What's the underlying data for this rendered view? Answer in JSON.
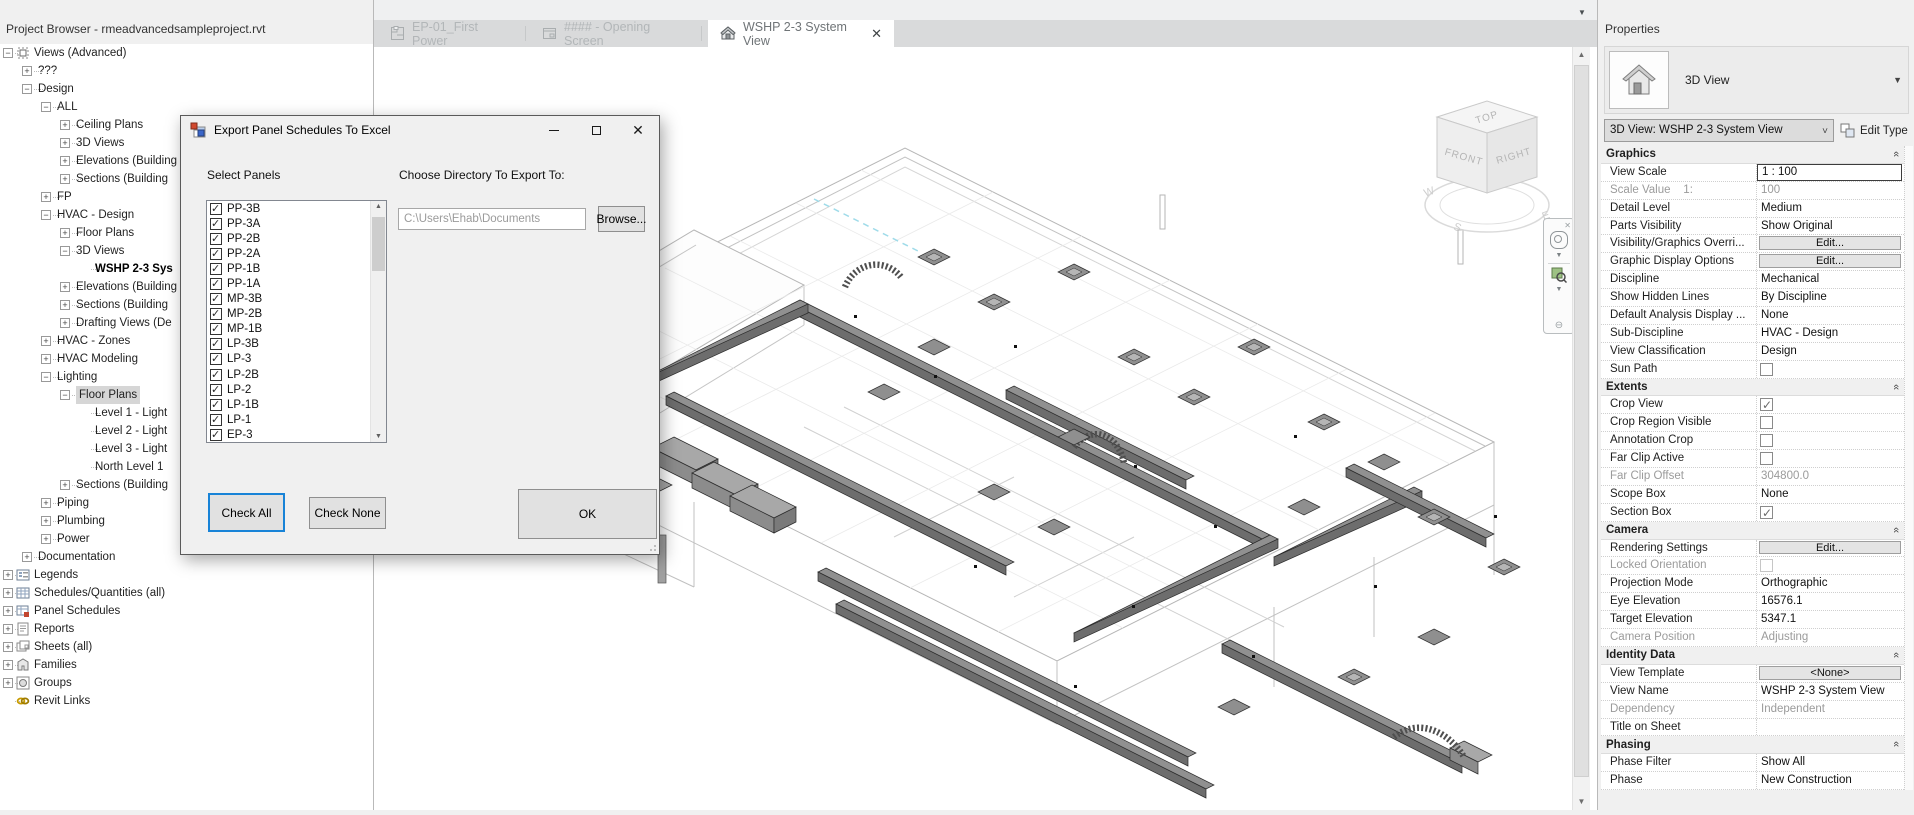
{
  "project_browser": {
    "title": "Project Browser - rmeadvancedsampleproject.rvt",
    "tree": [
      {
        "label": "Views (Advanced)",
        "level": 0,
        "toggle": "minus",
        "icon": "views"
      },
      {
        "label": "???",
        "level": 1,
        "toggle": "plus"
      },
      {
        "label": "Design",
        "level": 1,
        "toggle": "minus"
      },
      {
        "label": "ALL",
        "level": 2,
        "toggle": "minus"
      },
      {
        "label": "Ceiling Plans",
        "level": 3,
        "toggle": "plus"
      },
      {
        "label": "3D Views",
        "level": 3,
        "toggle": "plus"
      },
      {
        "label": "Elevations (Building",
        "level": 3,
        "toggle": "plus"
      },
      {
        "label": "Sections (Building",
        "level": 3,
        "toggle": "plus"
      },
      {
        "label": "FP",
        "level": 2,
        "toggle": "plus"
      },
      {
        "label": "HVAC - Design",
        "level": 2,
        "toggle": "minus"
      },
      {
        "label": "Floor Plans",
        "level": 3,
        "toggle": "plus"
      },
      {
        "label": "3D Views",
        "level": 3,
        "toggle": "minus"
      },
      {
        "label": "WSHP 2-3 Sys",
        "level": 4,
        "toggle": "none",
        "bold": true
      },
      {
        "label": "Elevations (Building",
        "level": 3,
        "toggle": "plus"
      },
      {
        "label": "Sections (Building",
        "level": 3,
        "toggle": "plus"
      },
      {
        "label": "Drafting Views (De",
        "level": 3,
        "toggle": "plus"
      },
      {
        "label": "HVAC - Zones",
        "level": 2,
        "toggle": "plus"
      },
      {
        "label": "HVAC Modeling",
        "level": 2,
        "toggle": "plus"
      },
      {
        "label": "Lighting",
        "level": 2,
        "toggle": "minus"
      },
      {
        "label": "Floor Plans",
        "level": 3,
        "toggle": "minus",
        "selected": true
      },
      {
        "label": "Level 1 - Light",
        "level": 4,
        "toggle": "none"
      },
      {
        "label": "Level 2 - Light",
        "level": 4,
        "toggle": "none"
      },
      {
        "label": "Level 3 - Light",
        "level": 4,
        "toggle": "none"
      },
      {
        "label": "North Level 1",
        "level": 4,
        "toggle": "none"
      },
      {
        "label": "Sections (Building",
        "level": 3,
        "toggle": "plus"
      },
      {
        "label": "Piping",
        "level": 2,
        "toggle": "plus"
      },
      {
        "label": "Plumbing",
        "level": 2,
        "toggle": "plus"
      },
      {
        "label": "Power",
        "level": 2,
        "toggle": "plus"
      },
      {
        "label": "Documentation",
        "level": 1,
        "toggle": "plus"
      },
      {
        "label": "Legends",
        "level": 0,
        "toggle": "plus",
        "icon": "legends"
      },
      {
        "label": "Schedules/Quantities (all)",
        "level": 0,
        "toggle": "plus",
        "icon": "schedule"
      },
      {
        "label": "Panel Schedules",
        "level": 0,
        "toggle": "plus",
        "icon": "panel-schedule"
      },
      {
        "label": "Reports",
        "level": 0,
        "toggle": "plus",
        "icon": "report"
      },
      {
        "label": "Sheets (all)",
        "level": 0,
        "toggle": "plus",
        "icon": "sheets"
      },
      {
        "label": "Families",
        "level": 0,
        "toggle": "plus",
        "icon": "families"
      },
      {
        "label": "Groups",
        "level": 0,
        "toggle": "plus",
        "icon": "groups"
      },
      {
        "label": "Revit Links",
        "level": 0,
        "toggle": "none",
        "icon": "link"
      }
    ]
  },
  "tabs": [
    {
      "label": "EP-01_First Power",
      "icon": "floor-plan-icon",
      "active": false
    },
    {
      "label": "#### - Opening Screen",
      "icon": "sheet-icon",
      "active": false
    },
    {
      "label": "WSHP 2-3 System View",
      "icon": "3d-view-icon",
      "active": true,
      "closable": true
    }
  ],
  "dialog": {
    "title": "Export Panel Schedules To Excel",
    "select_panels_label": "Select Panels",
    "directory_label": "Choose Directory To Export To:",
    "directory_path": "C:\\Users\\Ehab\\Documents",
    "browse_label": "Browse...",
    "check_all_label": "Check All",
    "check_none_label": "Check None",
    "ok_label": "OK",
    "panels": [
      {
        "name": "PP-3B",
        "checked": true
      },
      {
        "name": "PP-3A",
        "checked": true
      },
      {
        "name": "PP-2B",
        "checked": true
      },
      {
        "name": "PP-2A",
        "checked": true
      },
      {
        "name": "PP-1B",
        "checked": true
      },
      {
        "name": "PP-1A",
        "checked": true
      },
      {
        "name": "MP-3B",
        "checked": true
      },
      {
        "name": "MP-2B",
        "checked": true
      },
      {
        "name": "MP-1B",
        "checked": true
      },
      {
        "name": "LP-3B",
        "checked": true
      },
      {
        "name": "LP-3",
        "checked": true
      },
      {
        "name": "LP-2B",
        "checked": true
      },
      {
        "name": "LP-2",
        "checked": true
      },
      {
        "name": "LP-1B",
        "checked": true
      },
      {
        "name": "LP-1",
        "checked": true
      },
      {
        "name": "EP-3",
        "checked": true
      }
    ]
  },
  "properties": {
    "title": "Properties",
    "type_selector": {
      "category": "3D View"
    },
    "instance_combo": "3D View: WSHP 2-3 System View",
    "edit_type_label": "Edit Type",
    "sections": [
      {
        "title": "Graphics",
        "rows": [
          {
            "label": "View Scale",
            "value": "1 : 100",
            "type": "text-focused"
          },
          {
            "label": "Scale Value    1:",
            "value": "100",
            "type": "disabled",
            "dlabel": true
          },
          {
            "label": "Detail Level",
            "value": "Medium",
            "type": "text"
          },
          {
            "label": "Parts Visibility",
            "value": "Show Original",
            "type": "text"
          },
          {
            "label": "Visibility/Graphics Overri...",
            "value": "Edit...",
            "type": "button"
          },
          {
            "label": "Graphic Display Options",
            "value": "Edit...",
            "type": "button"
          },
          {
            "label": "Discipline",
            "value": "Mechanical",
            "type": "text"
          },
          {
            "label": "Show Hidden Lines",
            "value": "By Discipline",
            "type": "text"
          },
          {
            "label": "Default Analysis Display ...",
            "value": "None",
            "type": "text"
          },
          {
            "label": "Sub-Discipline",
            "value": "HVAC - Design",
            "type": "text",
            "side_btn": true
          },
          {
            "label": "View Classification",
            "value": "Design",
            "type": "text",
            "side_btn": true
          },
          {
            "label": "Sun Path",
            "value": "",
            "type": "checkbox"
          }
        ]
      },
      {
        "title": "Extents",
        "rows": [
          {
            "label": "Crop View",
            "value": "",
            "type": "checkbox-checked"
          },
          {
            "label": "Crop Region Visible",
            "value": "",
            "type": "checkbox"
          },
          {
            "label": "Annotation Crop",
            "value": "",
            "type": "checkbox"
          },
          {
            "label": "Far Clip Active",
            "value": "",
            "type": "checkbox"
          },
          {
            "label": "Far Clip Offset",
            "value": "304800.0",
            "type": "disabled",
            "dlabel": true
          },
          {
            "label": "Scope Box",
            "value": "None",
            "type": "text"
          },
          {
            "label": "Section Box",
            "value": "",
            "type": "checkbox-checked"
          }
        ]
      },
      {
        "title": "Camera",
        "rows": [
          {
            "label": "Rendering Settings",
            "value": "Edit...",
            "type": "button"
          },
          {
            "label": "Locked Orientation",
            "value": "",
            "type": "checkbox-disabled",
            "dlabel": true
          },
          {
            "label": "Projection Mode",
            "value": "Orthographic",
            "type": "text"
          },
          {
            "label": "Eye Elevation",
            "value": "16576.1",
            "type": "text"
          },
          {
            "label": "Target Elevation",
            "value": "5347.1",
            "type": "text"
          },
          {
            "label": "Camera Position",
            "value": "Adjusting",
            "type": "disabled",
            "dlabel": true
          }
        ]
      },
      {
        "title": "Identity Data",
        "rows": [
          {
            "label": "View Template",
            "value": "<None>",
            "type": "button"
          },
          {
            "label": "View Name",
            "value": "WSHP 2-3 System View",
            "type": "text"
          },
          {
            "label": "Dependency",
            "value": "Independent",
            "type": "disabled",
            "dlabel": true
          },
          {
            "label": "Title on Sheet",
            "value": "",
            "type": "empty"
          }
        ]
      },
      {
        "title": "Phasing",
        "rows": [
          {
            "label": "Phase Filter",
            "value": "Show All",
            "type": "text"
          },
          {
            "label": "Phase",
            "value": "New Construction",
            "type": "text"
          }
        ]
      }
    ]
  },
  "viewcube": {
    "top": "TOP",
    "front": "FRONT",
    "right": "RIGHT",
    "west": "W",
    "south": "S",
    "east": "E"
  },
  "colors": {
    "focus_blue": "#1883d7",
    "duct_gray": "#909090",
    "shell_gray": "#b6b6b6",
    "selection_gray": "#d6d6d6"
  }
}
